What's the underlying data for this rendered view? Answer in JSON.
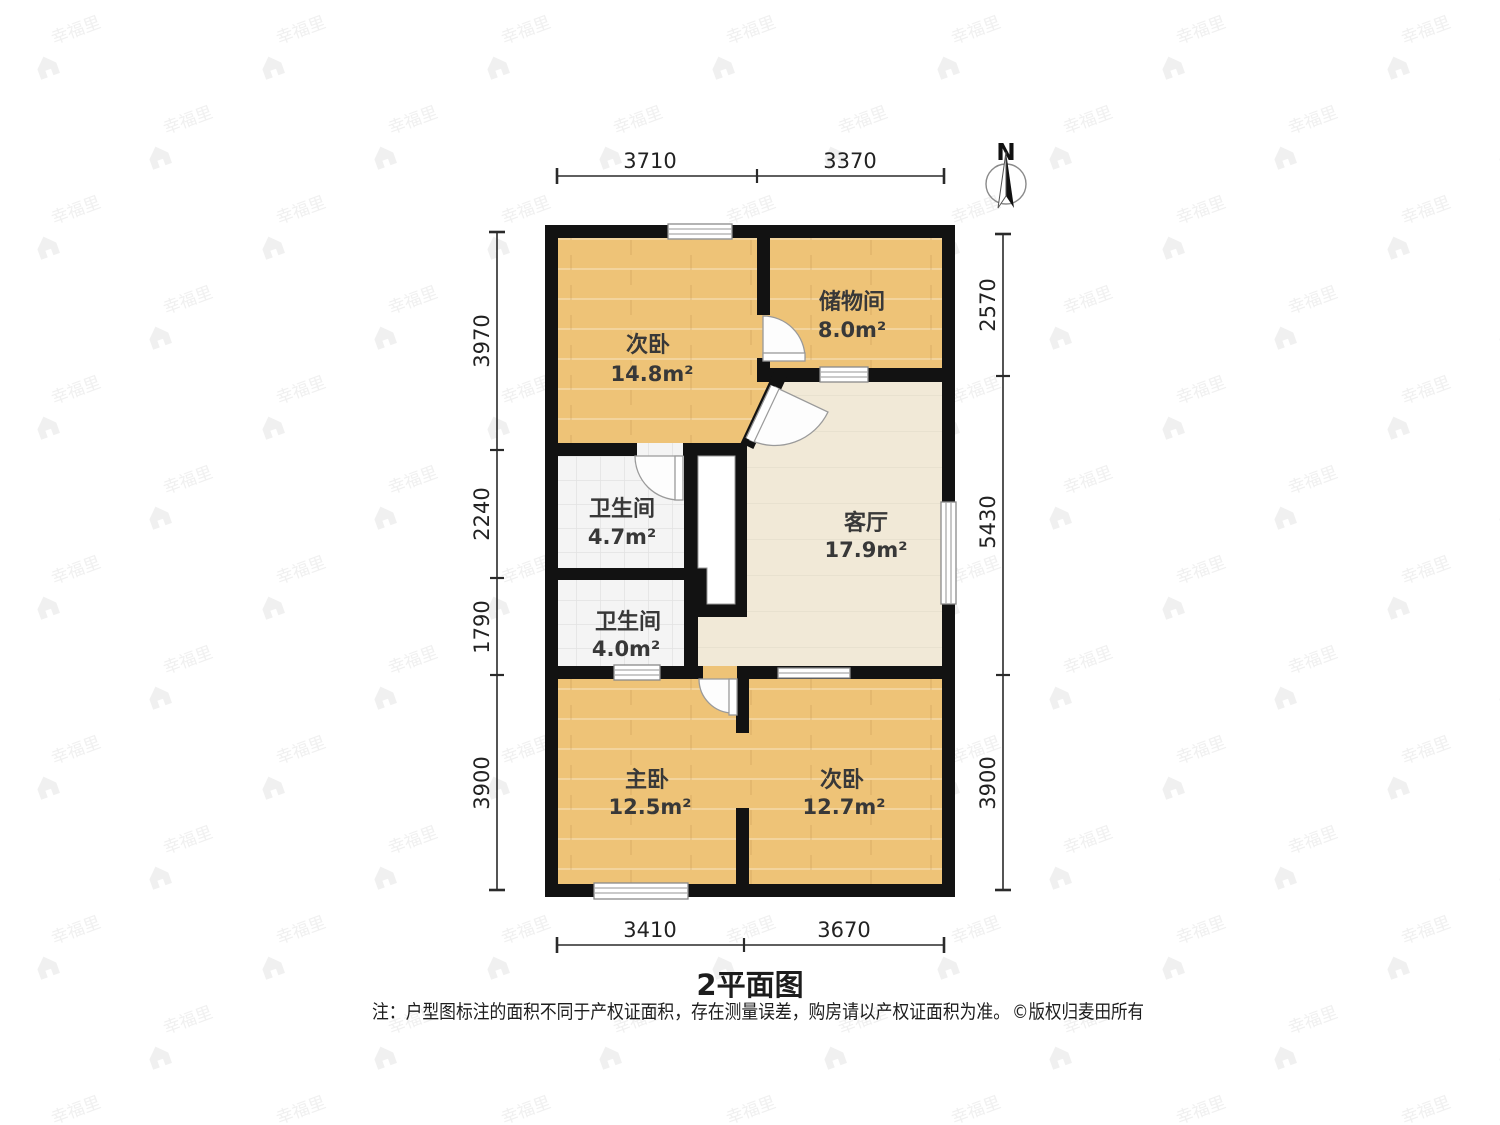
{
  "title": "2平面图",
  "footer": {
    "note": "注：户型图标注的面积不同于产权证面积，存在测量误差，购房请以产权证面积为准。",
    "copyright": "©版权归麦田所有"
  },
  "compass": {
    "label": "N"
  },
  "watermark": {
    "text": "幸福里",
    "icon": "house-logo-icon"
  },
  "colors": {
    "wall": "#121212",
    "wood": "#eec377",
    "beige": "#f1e9d7",
    "tile": "#f4f4f4",
    "dimension": "#2a2a2a"
  },
  "rooms": [
    {
      "id": "bedroom-top",
      "name": "次卧",
      "area": "14.8m²"
    },
    {
      "id": "storage-room",
      "name": "储物间",
      "area": "8.0m²"
    },
    {
      "id": "bathroom-upper",
      "name": "卫生间",
      "area": "4.7m²"
    },
    {
      "id": "living-room",
      "name": "客厅",
      "area": "17.9m²"
    },
    {
      "id": "bathroom-lower",
      "name": "卫生间",
      "area": "4.0m²"
    },
    {
      "id": "master-bedroom",
      "name": "主卧",
      "area": "12.5m²"
    },
    {
      "id": "bedroom-bottom",
      "name": "次卧",
      "area": "12.7m²"
    }
  ],
  "dimensions": {
    "top": [
      "3710",
      "3370"
    ],
    "bottom": [
      "3410",
      "3670"
    ],
    "left": [
      "3970",
      "2240",
      "1790",
      "3900"
    ],
    "right": [
      "2570",
      "5430",
      "3900"
    ]
  }
}
